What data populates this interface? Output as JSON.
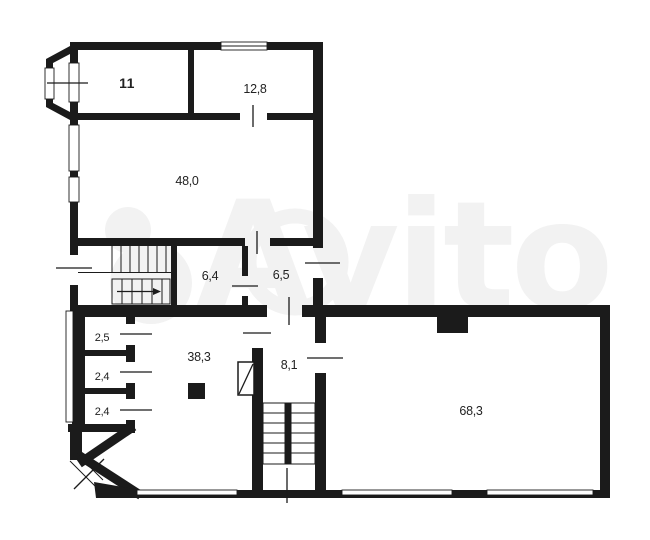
{
  "plan": {
    "wall_color": "#1b1b1b",
    "background_color": "#ffffff",
    "label_color": "#222222",
    "watermark": {
      "text": "Avito",
      "color": "#f2f2f2"
    },
    "rooms": [
      {
        "name": "room-11",
        "label": "11"
      },
      {
        "name": "room-12-8",
        "label": "12,8"
      },
      {
        "name": "room-48-0",
        "label": "48,0"
      },
      {
        "name": "room-6-4",
        "label": "6,4"
      },
      {
        "name": "room-6-5",
        "label": "6,5"
      },
      {
        "name": "room-2-5",
        "label": "2,5"
      },
      {
        "name": "room-2-4-a",
        "label": "2,4"
      },
      {
        "name": "room-2-4-b",
        "label": "2,4"
      },
      {
        "name": "room-38-3",
        "label": "38,3"
      },
      {
        "name": "room-8-1",
        "label": "8,1"
      },
      {
        "name": "room-68-3",
        "label": "68,3"
      }
    ]
  }
}
